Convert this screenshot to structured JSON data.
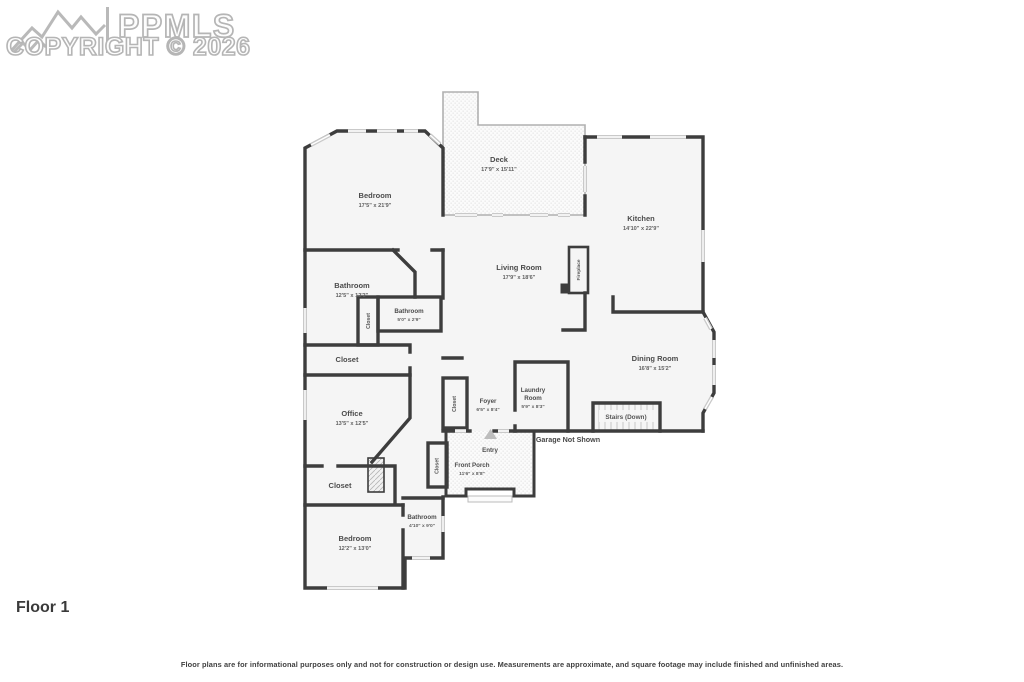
{
  "watermark": {
    "brand": "PPMLS",
    "copyright": "COPYRIGHT © 2026"
  },
  "floor_label": "Floor 1",
  "disclaimer": "Floor plans are for informational purposes only and not for construction or design use. Measurements are approximate, and square footage may include finished and unfinished areas.",
  "colors": {
    "wall": "#3d3d3d",
    "floor": "#f5f5f5",
    "window": "#c9c9c9",
    "watermark_outline": "#b5b5b5"
  },
  "rooms": {
    "bedroom_upper": {
      "name": "Bedroom",
      "dims": "17'5\" x 21'9\""
    },
    "deck": {
      "name": "Deck",
      "dims": "17'9\" x 15'11\""
    },
    "kitchen": {
      "name": "Kitchen",
      "dims": "14'10\" x 22'9\""
    },
    "living_room": {
      "name": "Living Room",
      "dims": "17'9\" x 18'6\""
    },
    "fireplace": {
      "name": "Fireplace"
    },
    "bathroom_large": {
      "name": "Bathroom",
      "dims": "12'5\" x 12'3\""
    },
    "bathroom_small": {
      "name": "Bathroom",
      "dims": "5'0\" x 2'9\""
    },
    "closet_bath": {
      "name": "Closet"
    },
    "closet_mid": {
      "name": "Closet"
    },
    "office": {
      "name": "Office",
      "dims": "13'5\" x 12'5\""
    },
    "dining_room": {
      "name": "Dining Room",
      "dims": "16'8\" x 15'2\""
    },
    "stairs": {
      "name": "Stairs (Down)"
    },
    "garage_note": {
      "name": "Garage Not Shown"
    },
    "closet_foyer": {
      "name": "Closet"
    },
    "foyer": {
      "name": "Foyer",
      "dims": "6'5\" x 8'4\""
    },
    "laundry": {
      "line1": "Laundry",
      "line2": "Room",
      "dims": "5'9\" x 8'3\""
    },
    "entry": {
      "name": "Entry"
    },
    "front_porch": {
      "name": "Front Porch",
      "dims": "11'6\" x 8'8\""
    },
    "closet_entry": {
      "name": "Closet"
    },
    "closet_lower": {
      "name": "Closet"
    },
    "bedroom_lower": {
      "name": "Bedroom",
      "dims": "12'2\" x 13'0\""
    },
    "bathroom_lower": {
      "name": "Bathroom",
      "dims": "4'10\" x 9'0\""
    }
  }
}
